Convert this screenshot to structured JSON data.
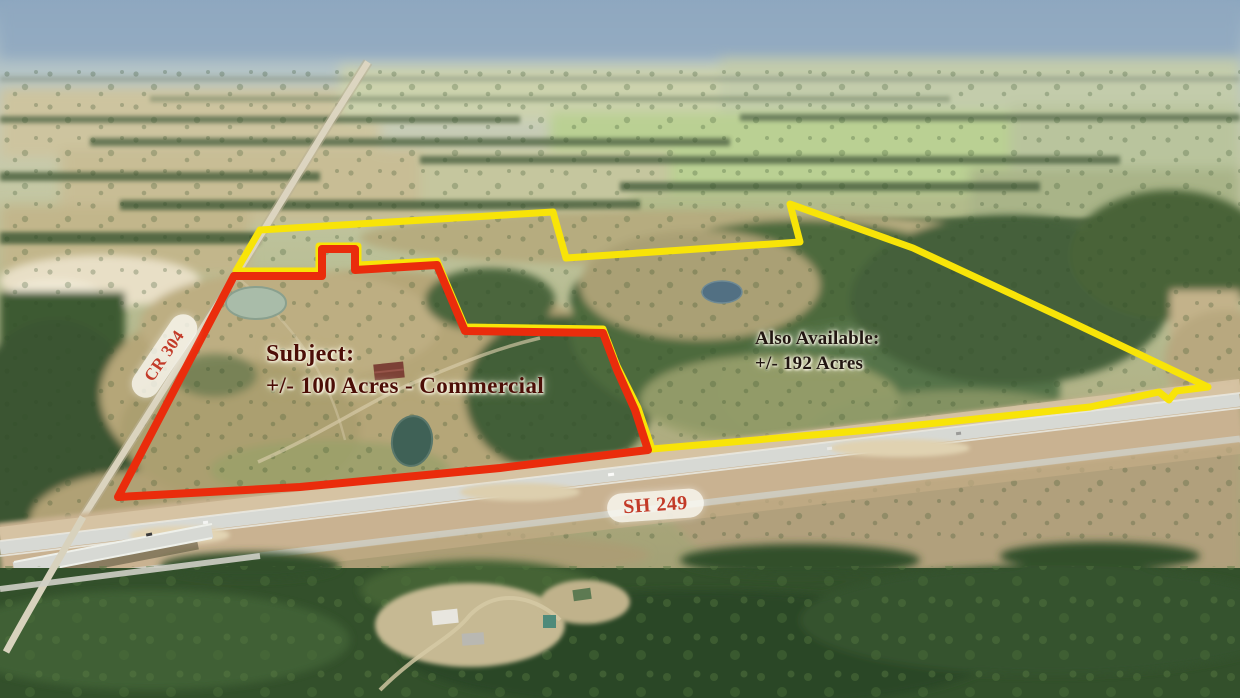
{
  "labels": {
    "subject": {
      "title": "Subject:",
      "detail": "+/- 100 Acres - Commercial",
      "text_color": "#4c0e07"
    },
    "also_available": {
      "title": "Also Available:",
      "detail": "+/- 192 Acres",
      "text_color": "#221712"
    },
    "cr_304": {
      "text": "CR 304"
    },
    "sh_249": {
      "text": "SH 249"
    },
    "road_label_text_color": "#c33a28",
    "road_label_bg": "rgba(252,251,245,0.8)"
  },
  "overlays": {
    "subject_parcel": {
      "outline_color": "#ea2c0c",
      "points": "234,276 322,276 322,249 355,249 355,270 437,265 465,331 603,333 617,370 635,410 648,450 500,468 300,487 118,497"
    },
    "available_parcel": {
      "outline_color": "#f8e408",
      "points": "260,230 553,212 566,258 800,242 790,204 913,248 1063,318 1208,387 1176,391 1169,400 1159,392 1090,407 870,430 652,449 638,408 617,366 603,329 465,327 437,261 358,265 358,246 319,246 319,271 236,271"
    }
  }
}
